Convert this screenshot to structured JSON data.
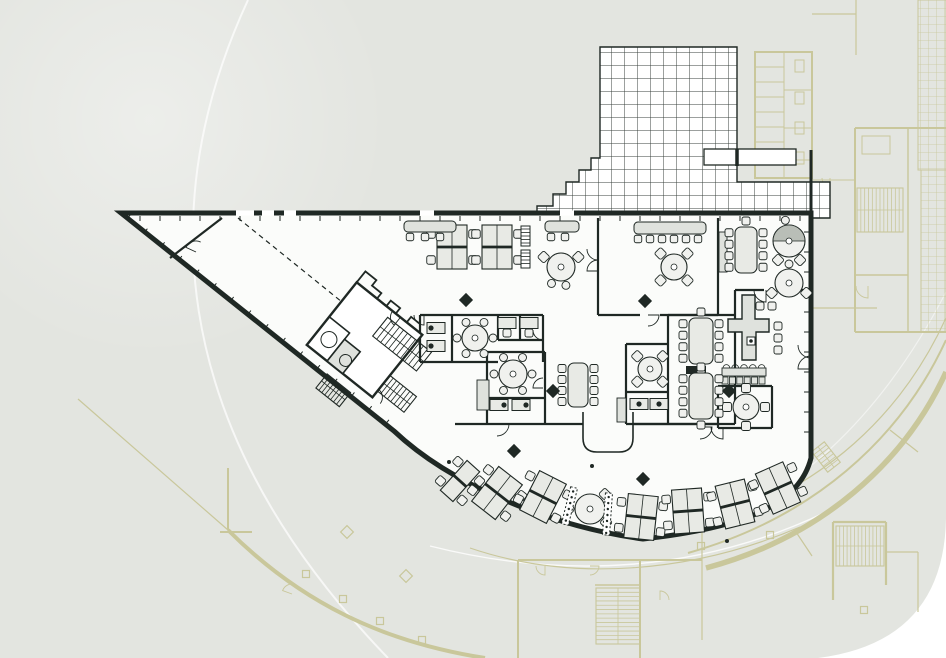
{
  "meta": {
    "title": "office-floor-plan-drawing",
    "canvas": {
      "w": 946,
      "h": 658
    }
  },
  "colors": {
    "page": "#ffffff",
    "panel": "#e3e5e0",
    "floor": "#fbfcfa",
    "ink": "#1f2824",
    "furn_fill": "#e8eae5",
    "furn_light": "#f0f1ee",
    "grey_fill": "#dfe2dd",
    "hood": "#b9beb7",
    "olive": "#c9c79b",
    "white_line": "#ffffff"
  },
  "panel": {
    "d": "M0,0 H946 V518 Q944,642 818,658 H0 Z"
  },
  "decor": {
    "haze": {
      "cx": 150,
      "cy": 120,
      "r": 240
    },
    "white_arcs": [
      {
        "d": "M248,0 C160,190 158,420 388,658",
        "w": 2,
        "o": 0.7
      },
      {
        "d": "M430,546 C565,580 700,572 826,512",
        "w": 1.4,
        "o": 0.8
      },
      {
        "d": "M946,292 C880,420 790,500 690,535",
        "w": 1.2,
        "o": 0.5
      }
    ]
  },
  "site_plan": {
    "paths": [
      {
        "d": "M78,399 L228,530",
        "w": 1.2
      },
      {
        "d": "M228,468 V530",
        "w": 2
      },
      {
        "d": "M220,532 H252",
        "w": 2
      },
      {
        "d": "M228,530 C300,602 382,642 485,658",
        "w": 4
      },
      {
        "d": "M518,560 V658",
        "w": 2
      },
      {
        "d": "M518,560 H702",
        "w": 2
      },
      {
        "d": "M640,560 V658",
        "w": 2
      },
      {
        "d": "M702,532 V640",
        "w": 1.2
      },
      {
        "d": "M595,585 H640",
        "w": 1.5
      },
      {
        "d": "M470,548 C570,582 690,574 800,527",
        "w": 1.1
      },
      {
        "d": "M812,308 H877",
        "w": 1.2
      },
      {
        "d": "M856,0 V55",
        "w": 1.2
      },
      {
        "d": "M812,14 H856",
        "w": 1.2
      },
      {
        "d": "M946,340 C900,440 812,518 688,553",
        "w": 2
      },
      {
        "d": "M946,372 C905,462 822,537 706,568",
        "w": 5.5
      },
      {
        "d": "M946,318 C903,412 826,489 700,527",
        "w": 1.2
      },
      {
        "d": "M890,430 L918,452",
        "w": 1.2
      },
      {
        "d": "M796,532 L812,556",
        "w": 1.2
      },
      {
        "d": "M833,522 V600",
        "w": 2.2
      },
      {
        "d": "M886,522 V585",
        "w": 2.2
      },
      {
        "d": "M833,522 H886",
        "w": 2.2
      },
      {
        "d": "M886,552 H918",
        "w": 1.2
      },
      {
        "d": "M918,552 V612",
        "w": 1.2
      },
      {
        "d": "M755,52 H812 V178 H755 Z",
        "w": 2
      },
      {
        "d": "M784,52 V178",
        "w": 1
      },
      {
        "d": "M755,67 H784",
        "w": 1
      },
      {
        "d": "M755,82 H784",
        "w": 1
      },
      {
        "d": "M755,97 H784",
        "w": 1
      },
      {
        "d": "M755,112 H784",
        "w": 1
      },
      {
        "d": "M755,127 H784",
        "w": 1
      },
      {
        "d": "M755,142 H784",
        "w": 1
      },
      {
        "d": "M755,157 H784",
        "w": 1
      },
      {
        "d": "M784,90 H812",
        "w": 1
      },
      {
        "d": "M784,128 H812",
        "w": 1
      },
      {
        "d": "M784,160 H812",
        "w": 1
      },
      {
        "d": "M855,128 H946",
        "w": 2
      },
      {
        "d": "M855,128 V332",
        "w": 2
      },
      {
        "d": "M855,332 H946",
        "w": 2
      },
      {
        "d": "M908,128 V332",
        "w": 1.4
      },
      {
        "d": "M855,275 H908",
        "w": 1.4
      },
      {
        "d": "M812,180 H855",
        "w": 1
      }
    ],
    "rects": [
      {
        "x": 795,
        "y": 60,
        "w": 9,
        "h": 12
      },
      {
        "x": 795,
        "y": 92,
        "w": 9,
        "h": 12
      },
      {
        "x": 795,
        "y": 122,
        "w": 9,
        "h": 12
      },
      {
        "x": 795,
        "y": 152,
        "w": 9,
        "h": 12
      },
      {
        "x": 862,
        "y": 136,
        "w": 28,
        "h": 18
      }
    ],
    "squares": [
      [
        306,
        574
      ],
      [
        343,
        599
      ],
      [
        380,
        621
      ],
      [
        422,
        640
      ],
      [
        770,
        535
      ],
      [
        701,
        546
      ],
      [
        864,
        610
      ]
    ],
    "diamonds": [
      [
        347,
        532
      ],
      [
        406,
        576
      ]
    ],
    "stairs": [
      {
        "x": 857,
        "y": 188,
        "w": 46,
        "h": 44,
        "dir": "v",
        "n": 11,
        "rot": 0
      },
      {
        "x": 836,
        "y": 526,
        "w": 48,
        "h": 40,
        "dir": "v",
        "n": 12,
        "rot": 0
      },
      {
        "x": 596,
        "y": 588,
        "w": 44,
        "h": 56,
        "dir": "h",
        "n": 12,
        "rot": 0
      },
      {
        "x": 818,
        "y": 444,
        "w": 16,
        "h": 26,
        "dir": "h",
        "n": 6,
        "rot": -38
      }
    ],
    "door_arcs": [
      {
        "cx": 868,
        "cy": 286,
        "r": 12,
        "a0": 90,
        "a1": 180
      },
      {
        "cx": 292,
        "cy": 594,
        "r": 10,
        "a0": 200,
        "a1": 290
      },
      {
        "cx": 545,
        "cy": 566,
        "r": 9,
        "a0": 90,
        "a1": 180
      },
      {
        "cx": 590,
        "cy": 566,
        "r": 9,
        "a0": 0,
        "a1": 90
      },
      {
        "cx": 660,
        "cy": 600,
        "r": 9,
        "a0": 270,
        "a1": 360
      },
      {
        "cx": 830,
        "cy": 178,
        "r": 8,
        "a0": 90,
        "a1": 180
      }
    ],
    "grids": [
      {
        "x": 918,
        "y": 0,
        "w": 28,
        "h": 170
      },
      {
        "x": 921,
        "y": 170,
        "w": 25,
        "h": 162
      }
    ]
  },
  "terrace": {
    "outline_d": "M537,218 V206 H553 V194 H566 V182 H579 V170 H591 V158 H600 V47 H737 V182 H830 V218 Z",
    "planter": {
      "x": 704,
      "y": 149,
      "w": 92,
      "h": 16
    },
    "extras": [
      {
        "d": "M811,150 V218",
        "w": 3
      },
      {
        "d": "M737,149 V166",
        "w": 3.5
      }
    ]
  },
  "building": {
    "outline_d": "M121,213 H811 V458 C799,506 742,528 643,539 C548,526 449,483 394,431 Z",
    "windows": [
      {
        "x": 236,
        "w": 18
      },
      {
        "x": 262,
        "w": 12
      },
      {
        "x": 284,
        "w": 12
      },
      {
        "x": 420,
        "w": 14
      },
      {
        "x": 560,
        "w": 14
      }
    ],
    "walls": [
      "M598,218 V315",
      "M718,218 V315",
      "M598,315 H640",
      "M660,315 H718",
      "M420,315 H543",
      "M420,315 V362",
      "M452,315 V362",
      "M498,315 V340",
      "M520,315 V340",
      "M543,315 V362",
      "M420,362 H498",
      "M498,340 H543",
      "M487,352 H545",
      "M487,352 V424",
      "M545,352 V424",
      "M487,398 H545",
      "M455,424 H583",
      "M633,424 H718",
      "M668,315 V424",
      "M735,315 V424",
      "M668,315 H735",
      "M668,424 H735",
      "M626,344 H668",
      "M626,344 V392",
      "M626,392 H668",
      "M626,392 V424",
      "M626,424 H668",
      "M735,290 H764",
      "M788,290 H811",
      "M735,290 V315",
      "M718,386 H772",
      "M718,386 V428",
      "M772,386 V428",
      "M718,428 H772",
      "M222,218 L170,258"
    ],
    "dashed": [
      "M238,218 L342,302"
    ],
    "black_rects": [
      [
        686,
        366,
        20,
        8
      ]
    ],
    "notch_d": "M583,412 V438 Q583,452 597,452 H619 Q633,452 633,438 V412",
    "radiator": {
      "x": 722,
      "y": 368,
      "w": 44,
      "h": 8,
      "n": 5
    },
    "grey_rects": [
      {
        "x": 719,
        "y": 232,
        "w": 8,
        "h": 40
      },
      {
        "x": 477,
        "y": 380,
        "w": 12,
        "h": 30
      },
      {
        "x": 617,
        "y": 398,
        "w": 9,
        "h": 24
      }
    ],
    "door_arcs": [
      {
        "cx": 196,
        "cy": 252,
        "r": 11,
        "a0": 205,
        "a1": 295
      },
      {
        "cx": 598,
        "cy": 249,
        "r": 11,
        "a0": 90,
        "a1": 180
      },
      {
        "cx": 598,
        "cy": 271,
        "r": 11,
        "a0": 180,
        "a1": 270
      },
      {
        "cx": 424,
        "cy": 315,
        "r": 10,
        "a0": 90,
        "a1": 180
      },
      {
        "cx": 543,
        "cy": 330,
        "r": 10,
        "a0": 90,
        "a1": 180
      },
      {
        "cx": 543,
        "cy": 388,
        "r": 10,
        "a0": 180,
        "a1": 270
      },
      {
        "cx": 497,
        "cy": 424,
        "r": 12,
        "a0": 0,
        "a1": 90
      },
      {
        "cx": 648,
        "cy": 315,
        "r": 11,
        "a0": 0,
        "a1": 90
      },
      {
        "cx": 700,
        "cy": 427,
        "r": 12,
        "a0": 0,
        "a1": 90
      },
      {
        "cx": 723,
        "cy": 427,
        "r": 12,
        "a0": 90,
        "a1": 180
      },
      {
        "cx": 766,
        "cy": 290,
        "r": 12,
        "a0": 90,
        "a1": 180
      },
      {
        "cx": 811,
        "cy": 345,
        "r": 13,
        "a0": 90,
        "a1": 180
      },
      {
        "cx": 811,
        "cy": 369,
        "r": 13,
        "a0": 180,
        "a1": 270
      },
      {
        "cx": 352,
        "cy": 306,
        "r": 11,
        "a0": 210,
        "a1": 300
      },
      {
        "cx": 668,
        "cy": 398,
        "r": 10,
        "a0": 90,
        "a1": 180
      }
    ],
    "ticks": {
      "top": {
        "x1": 140,
        "x2": 806,
        "y": 216,
        "step": 20,
        "len": 5
      },
      "right": {
        "y1": 232,
        "y2": 450,
        "x": 809,
        "step": 20,
        "len": 5
      },
      "diag": {
        "from": [
          127,
          219
        ],
        "to": [
          390,
          427
        ],
        "step": 22,
        "len": 5
      }
    }
  },
  "core": {
    "cx": 383,
    "cy": 352,
    "angle": 38.6,
    "outline": {
      "x": -64,
      "y": -38,
      "w": 84,
      "h": 80
    },
    "parapet_d": "M-64,-38 v-14 h14 v7 h12 v7 h12 v-7 h12 v7 h14 v-7 h12",
    "stairs": [
      {
        "x": -18,
        "y": -30,
        "w": 56,
        "h": 24,
        "dir": "v",
        "n": 10
      },
      {
        "x": 20,
        "y": 14,
        "w": 34,
        "h": 20,
        "dir": "v",
        "n": 7
      },
      {
        "x": -30,
        "y": 52,
        "w": 30,
        "h": 18,
        "dir": "v",
        "n": 7
      }
    ],
    "rooms": [
      {
        "x": -64,
        "y": 6,
        "w": 26,
        "h": 36,
        "fill": "none"
      },
      {
        "x": -38,
        "y": 14,
        "w": 20,
        "h": 28,
        "fill": "grey"
      }
    ],
    "circles": [
      {
        "x": -50,
        "y": 24,
        "r": 8
      },
      {
        "x": -24,
        "y": 30,
        "r": 6
      }
    ],
    "arcs": [
      {
        "cx": -8,
        "cy": -38,
        "r": 10,
        "a0": 90,
        "a1": 180
      },
      {
        "cx": 20,
        "cy": 42,
        "r": 10,
        "a0": 270,
        "a1": 360
      }
    ]
  },
  "furniture": {
    "desk_clusters": [
      {
        "x": 452,
        "y": 247,
        "rot": 0,
        "cols": 2
      },
      {
        "x": 497,
        "y": 247,
        "rot": 0,
        "cols": 2
      },
      {
        "x": 460,
        "y": 481,
        "rot": 42,
        "cols": 1
      },
      {
        "x": 497,
        "y": 493,
        "rot": 38,
        "cols": 2
      },
      {
        "x": 543,
        "y": 497,
        "rot": 27,
        "cols": 2
      },
      {
        "x": 641,
        "y": 517,
        "rot": 6,
        "cols": 2
      },
      {
        "x": 688,
        "y": 511,
        "rot": -4,
        "cols": 2
      },
      {
        "x": 735,
        "y": 504,
        "rot": -14,
        "cols": 2
      },
      {
        "x": 778,
        "y": 488,
        "rot": -24,
        "cols": 2
      }
    ],
    "round_tables": [
      {
        "x": 561,
        "y": 267,
        "r": 14,
        "diam": [
          210,
          330
        ],
        "circ": [
          75,
          120
        ]
      },
      {
        "x": 674,
        "y": 267,
        "r": 13,
        "diam": [
          45,
          135,
          225,
          315
        ]
      },
      {
        "x": 789,
        "y": 241,
        "r": 16,
        "diam": [
          60,
          120
        ],
        "circ": [
          260
        ],
        "hood": 1
      },
      {
        "x": 789,
        "y": 283,
        "r": 14,
        "diam": [
          30,
          150
        ],
        "circ": [
          270
        ]
      },
      {
        "x": 475,
        "y": 338,
        "r": 13,
        "circ": [
          0,
          60,
          120,
          180,
          240,
          300
        ]
      },
      {
        "x": 513,
        "y": 374,
        "r": 14,
        "circ": [
          0,
          60,
          120,
          180,
          240,
          300
        ]
      },
      {
        "x": 650,
        "y": 369,
        "r": 12,
        "diam": [
          45,
          135,
          225,
          315
        ]
      },
      {
        "x": 746,
        "y": 407,
        "r": 13,
        "sq": [
          0,
          90,
          180,
          270
        ]
      },
      {
        "x": 590,
        "y": 509,
        "r": 15,
        "diam": [
          315,
          40
        ],
        "circ": [
          180
        ]
      }
    ],
    "conf_tables": [
      {
        "x": 746,
        "y": 250,
        "w": 22,
        "h": 46,
        "side": 4,
        "ends": 1
      },
      {
        "x": 701,
        "y": 341,
        "w": 24,
        "h": 46,
        "side": 4,
        "ends": 2
      },
      {
        "x": 701,
        "y": 396,
        "w": 24,
        "h": 46,
        "side": 4,
        "ends": 2
      },
      {
        "x": 578,
        "y": 385,
        "w": 20,
        "h": 44,
        "side": 4,
        "ends": 0
      }
    ],
    "small_desks": [
      {
        "x": 436,
        "y": 328,
        "dot": "w"
      },
      {
        "x": 436,
        "y": 346,
        "dot": "w"
      },
      {
        "x": 507,
        "y": 323,
        "chair": "s"
      },
      {
        "x": 529,
        "y": 323,
        "chair": "s"
      },
      {
        "x": 499,
        "y": 405,
        "dot": "e"
      },
      {
        "x": 521,
        "y": 405,
        "dot": "e"
      },
      {
        "x": 639,
        "y": 404,
        "dot": "s"
      },
      {
        "x": 659,
        "y": 404,
        "dot": "s"
      }
    ],
    "shelves": [
      {
        "x": 521,
        "y": 226,
        "w": 9,
        "h": 20,
        "style": "stripe",
        "rot": 0
      },
      {
        "x": 521,
        "y": 250,
        "w": 9,
        "h": 18,
        "style": "stripe",
        "rot": 0
      },
      {
        "x": 566,
        "y": 487,
        "w": 7,
        "h": 38,
        "style": "dots",
        "rot": 14
      },
      {
        "x": 604,
        "y": 493,
        "w": 7,
        "h": 42,
        "style": "dots",
        "rot": 4
      }
    ],
    "counters": [
      {
        "x": 404,
        "y": 221,
        "w": 52,
        "h": 11
      },
      {
        "x": 545,
        "y": 221,
        "w": 34,
        "h": 11
      },
      {
        "x": 634,
        "y": 222,
        "w": 72,
        "h": 12
      }
    ],
    "chair_rows": [
      {
        "y": 237,
        "xs": [
          410,
          425,
          440
        ]
      },
      {
        "y": 237,
        "xs": [
          551,
          565
        ]
      },
      {
        "y": 239,
        "xs": [
          638,
          650,
          662,
          674,
          686,
          698
        ]
      }
    ],
    "reception": {
      "desk_d": "M742,295 H755 V319 H769 V332 H756 V360 H742 V332 H728 V319 H742 Z",
      "chairs": [
        [
          760,
          306
        ],
        [
          772,
          306
        ],
        [
          778,
          326
        ],
        [
          778,
          338
        ],
        [
          778,
          350
        ]
      ],
      "mark": [
        751,
        341
      ]
    },
    "columns": [
      [
        466,
        300
      ],
      [
        645,
        301
      ],
      [
        553,
        391
      ],
      [
        514,
        451
      ],
      [
        643,
        479
      ],
      [
        729,
        391
      ]
    ],
    "dots": [
      [
        449,
        462
      ],
      [
        592,
        466
      ],
      [
        727,
        541
      ]
    ]
  }
}
